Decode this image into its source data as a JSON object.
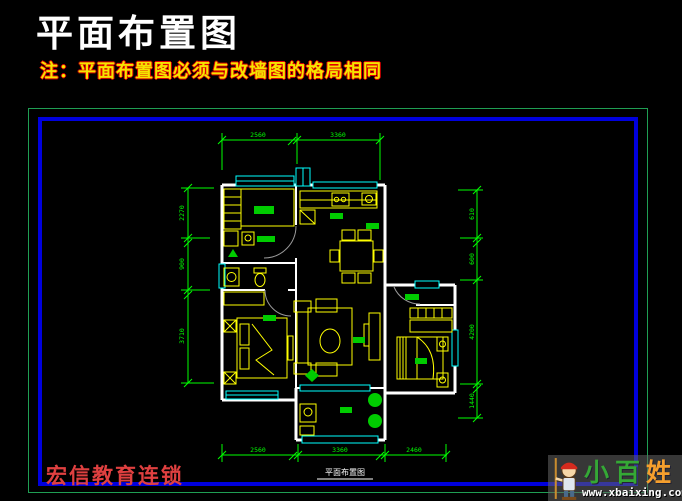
{
  "page": {
    "title": "平面布置图",
    "note": "注：平面布置图必须与改墙图的格局相同",
    "brand": "宏信教育连锁",
    "plan_caption": "平面布置图"
  },
  "watermark": {
    "char_1": "小",
    "char_2": "百",
    "char_3": "姓",
    "url": "www.xbaixing.com"
  },
  "dimensions": {
    "top": [
      "2560",
      "3360"
    ],
    "bottom": [
      "2560",
      "3360",
      "2460"
    ],
    "left": [
      "2270",
      "900",
      "3710"
    ],
    "right": [
      "610",
      "600",
      "4200",
      "1440"
    ]
  },
  "colors": {
    "background": "#000000",
    "title_text": "#ffffff",
    "note_fill": "#f5e400",
    "note_outline": "#e00000",
    "frame_outer": "#1f9e53",
    "frame_inner": "#0000dd",
    "wall": "#ffffff",
    "window": "#00ffff",
    "furniture": "#ffff00",
    "dimension": "#00ff00",
    "label_green": "#00cc00",
    "door_arc": "#9a9a9a",
    "brand_text": "#e04040",
    "logo_green": "#35a835",
    "logo_orange": "#f59f2d",
    "url_text": "#ffffff"
  }
}
